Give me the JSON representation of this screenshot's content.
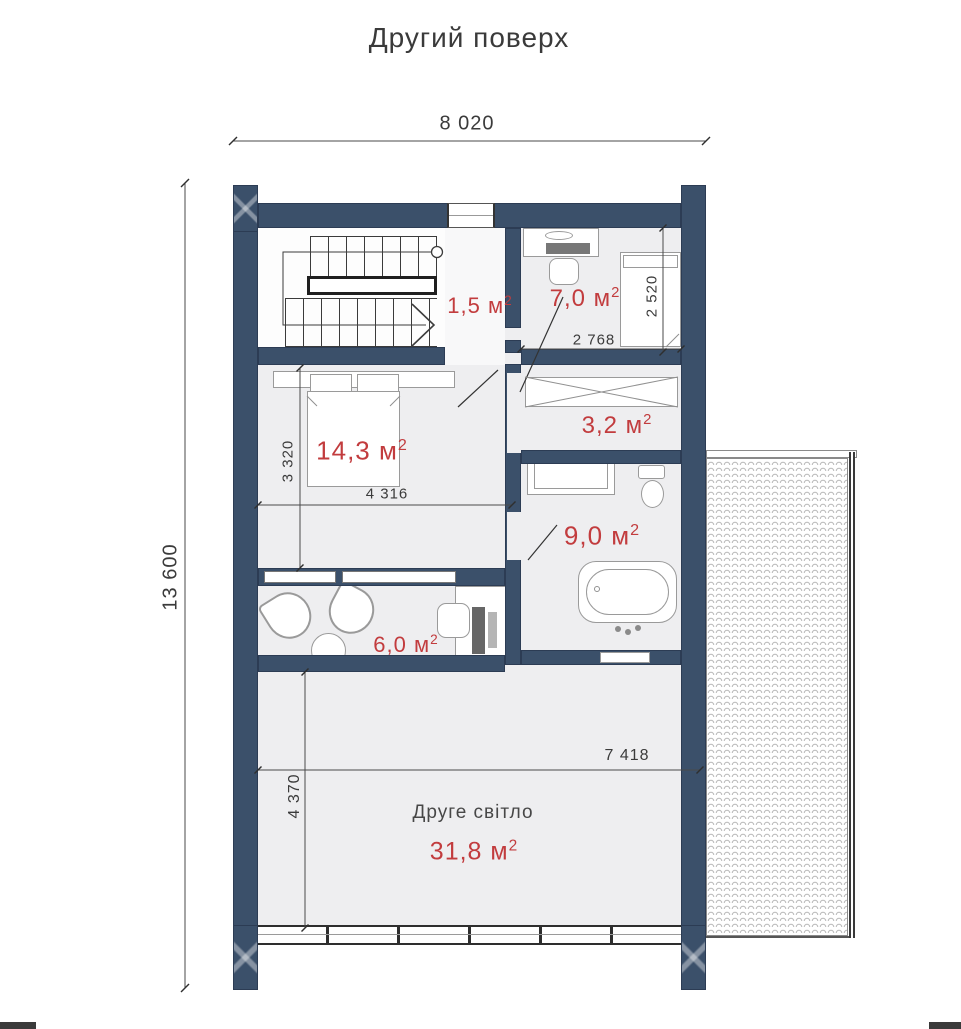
{
  "title": "Другий поверх",
  "unit_sup": "2",
  "dimensions": {
    "overall_width": "8 020",
    "overall_height": "13 600",
    "cabinet_bed_length": "2 520",
    "cabinet_width": "2 768",
    "bedroom_depth": "3 320",
    "bedroom_width": "4 316",
    "void_width": "7 418",
    "void_depth": "4 370"
  },
  "rooms": {
    "corridor": {
      "area_value": "1,5 м"
    },
    "cabinet": {
      "area_value": "7,0 м"
    },
    "bedroom": {
      "area_value": "14,3 м"
    },
    "wardrobe": {
      "area_value": "3,2 м"
    },
    "bathroom": {
      "area_value": "9,0 м"
    },
    "office": {
      "area_value": "6,0 м"
    },
    "second_light": {
      "label": "Друге світло",
      "area_value": "31,8 м"
    }
  },
  "colors": {
    "wall": "#3b506a",
    "area_label": "#c23c3e",
    "floor": "#eeeef0",
    "dimension_text": "#3b3b3b"
  }
}
